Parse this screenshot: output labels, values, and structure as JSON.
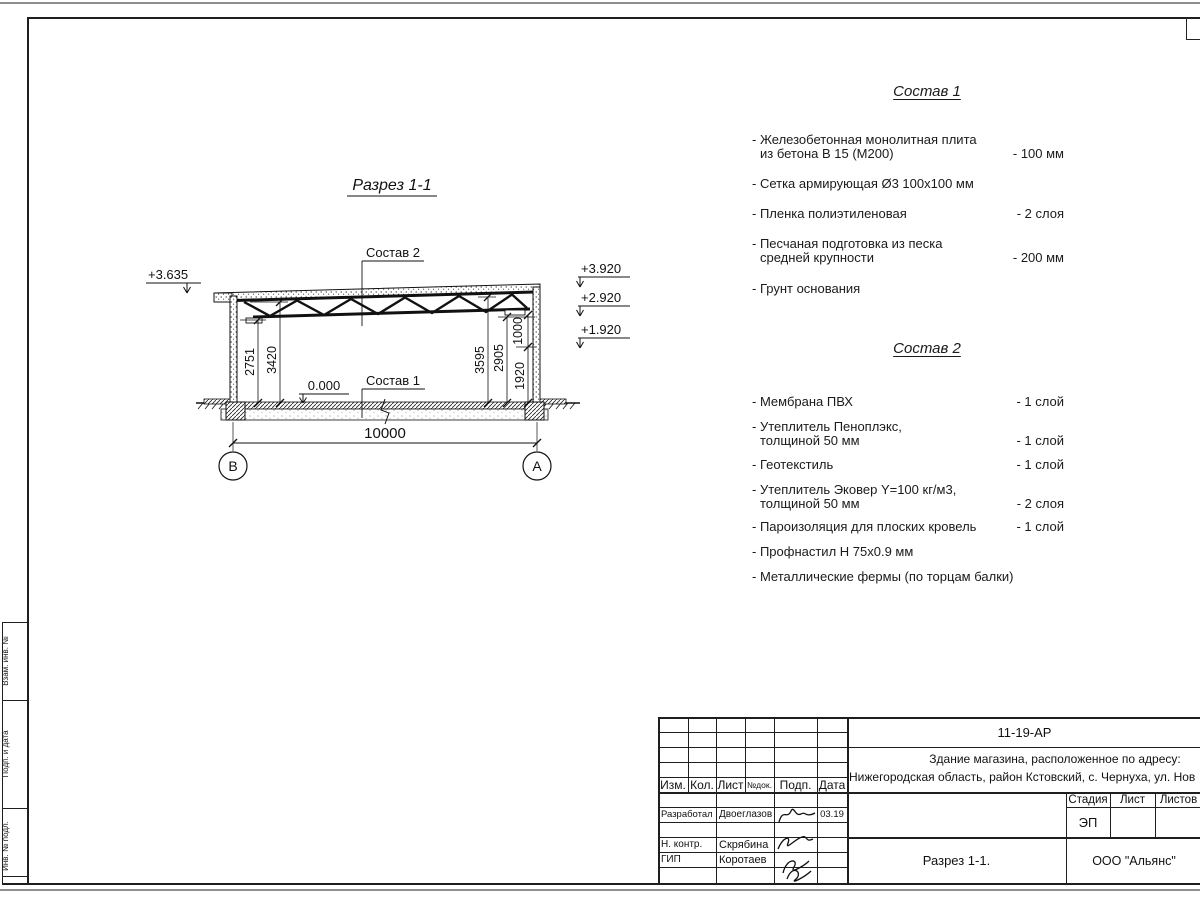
{
  "section": {
    "title": "Разрез 1-1",
    "label_sostav2": "Состав 2",
    "label_sostav1": "Состав 1",
    "zero_mark": "0.000",
    "elev_left": "+3.635",
    "elev_right": [
      "+3.920",
      "+2.920",
      "+1.920"
    ],
    "dims_left": [
      "2751",
      "3420"
    ],
    "dims_right": [
      "3595",
      "2905",
      "1920",
      "1000"
    ],
    "width_dim": "10000",
    "axis_left": "В",
    "axis_right": "А"
  },
  "spec1": {
    "heading": "Состав 1",
    "items": [
      {
        "l1": "- Железобетонная  монолитная плита",
        "l2": "из бетона В 15 (М200)",
        "v": "- 100 мм"
      },
      {
        "l1": "- Сетка армирующая Ø3 100х100 мм"
      },
      {
        "l1": "- Пленка полиэтиленовая",
        "v": "-  2 слоя"
      },
      {
        "l1": "- Песчаная подготовка из песка",
        "l2": "средней крупности",
        "v": "- 200 мм"
      },
      {
        "l1": "- Грунт основания"
      }
    ]
  },
  "spec2": {
    "heading": "Состав 2",
    "items": [
      {
        "l1": "- Мембрана ПВХ",
        "v": "- 1 слой"
      },
      {
        "l1": "- Утеплитель Пеноплэкс,",
        "l2": "толщиной 50 мм",
        "v": "- 1 слой"
      },
      {
        "l1": "- Геотекстиль",
        "v": "- 1 слой"
      },
      {
        "l1": "- Утеплитель Эковер Y=100 кг/м3,",
        "l2": "толщиной 50 мм",
        "v": "- 2 слоя"
      },
      {
        "l1": "- Пароизоляция для плоских кровель",
        "v": "- 1 слой"
      },
      {
        "l1": "- Профнастил Н 75х0.9 мм"
      },
      {
        "l1": "- Металлические фермы (по торцам балки)"
      }
    ]
  },
  "titleblock": {
    "doc_number": "11-19-АР",
    "address_line1": "Здание магазина, расположенное по адресу:",
    "address_line2": "Нижегородская область, район Кстовский, с. Чернуха, ул. Нов",
    "col_izm": "Изм.",
    "col_kol": "Кол.",
    "col_list": "Лист",
    "col_ndok": "№док.",
    "col_podp": "Подп.",
    "col_data": "Дата",
    "stage_label": "Стадия",
    "sheet_label": "Лист",
    "sheets_label": "Листов",
    "stage_value": "ЭП",
    "drawing_name": "Разрез 1-1.",
    "company": "ООО \"Альянс\"",
    "row1_role": "Разработал",
    "row1_name": "Двоеглазов",
    "row1_date": "03.19",
    "row2_role": "Н. контр.",
    "row2_name": "Скрябина",
    "row3_role": "ГИП",
    "row3_name": "Коротаев"
  },
  "side_stamp": {
    "label_top": "Взам. инв. №",
    "label_mid": "Подп. и дата",
    "label_bottom": "Инв. № подл."
  }
}
